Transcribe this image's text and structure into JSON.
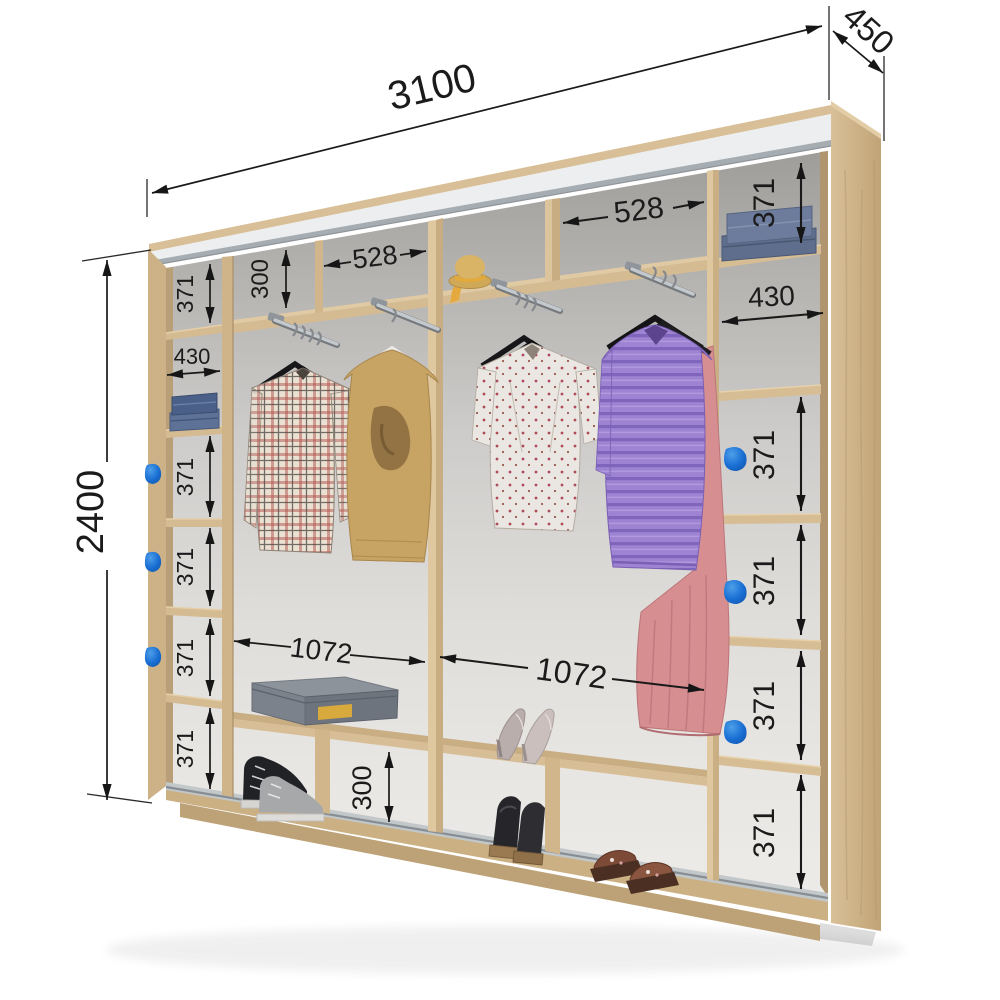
{
  "diagram_type": "wardrobe-interior-dimension-diagram",
  "overall": {
    "width": "3100",
    "depth": "450",
    "height": "2400"
  },
  "left_column": {
    "section_1": "371",
    "shelf_width": "430",
    "section_3": "371",
    "section_4": "371",
    "section_5": "371",
    "section_6": "371"
  },
  "right_column": {
    "section_1": "371",
    "shelf_width": "430",
    "section_3": "371",
    "section_4": "371",
    "section_5": "371",
    "section_6": "371"
  },
  "top_row": {
    "height": "300",
    "left_cubby_width": "528",
    "right_cubby_width": "528"
  },
  "hanging_sections": {
    "left_width": "1072",
    "right_width": "1072"
  },
  "bottom_row": {
    "height": "300"
  },
  "colors": {
    "handle_blue": "#1a6fd4",
    "wood_light": "#d7bd94",
    "wood_medium": "#cbb188",
    "rail_silver": "#edeff1",
    "back_wall_gray": "#d8d6d3",
    "dimension_ink": "#1b1b1b"
  },
  "depicted_items": [
    "folded-jeans",
    "folded-towels",
    "plaid-shirt",
    "tan-sweater",
    "floral-blouse",
    "striped-purple-sweater",
    "pink-skirt",
    "straw-hat",
    "shoe-box",
    "sneakers",
    "high-heels",
    "wedge-sandals",
    "clog-sandals",
    "blue-door-handles",
    "hanging-rods",
    "black-hangers"
  ]
}
